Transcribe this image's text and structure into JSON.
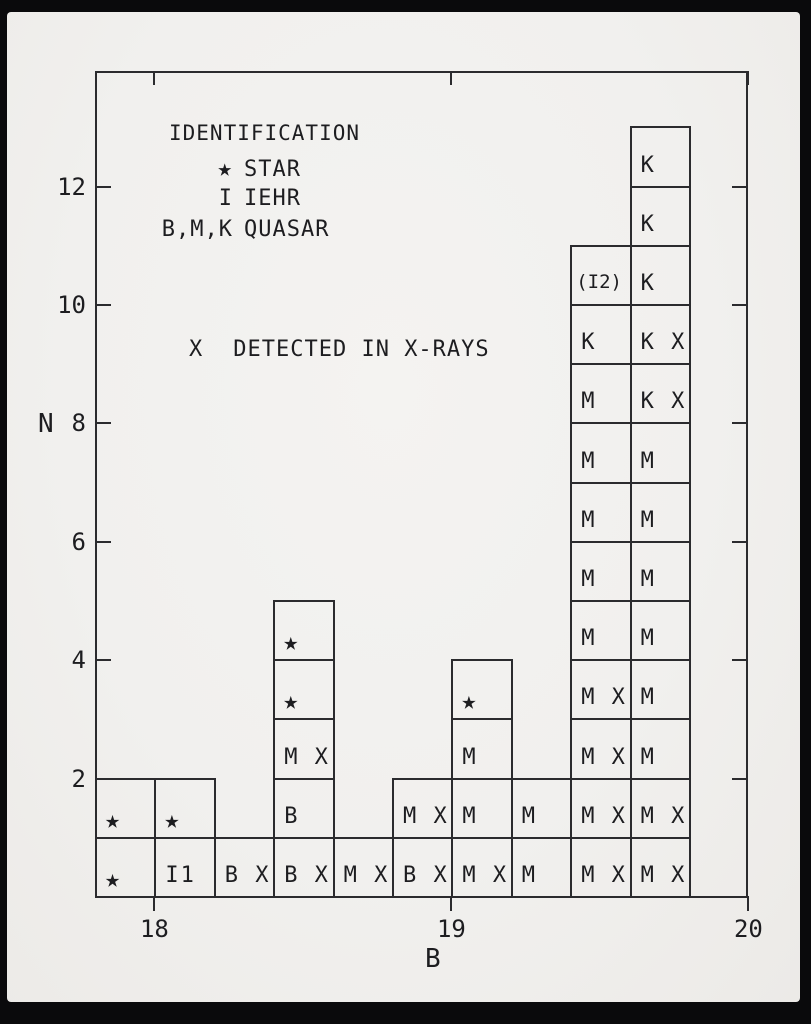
{
  "figure": {
    "paper_color": "#f1f0ee",
    "frame_color": "#0a0a0c",
    "line_color": "#2b2b2e",
    "text_color": "#1d1d20"
  },
  "legend": {
    "title": "IDENTIFICATION",
    "entries": [
      {
        "symbol": "★",
        "label": "STAR"
      },
      {
        "symbol": "I",
        "label": "IEHR"
      },
      {
        "symbol": "B,M,K",
        "label": "QUASAR"
      }
    ],
    "xray": {
      "symbol": "X",
      "label": "DETECTED IN X-RAYS"
    }
  },
  "chart_data": {
    "type": "bar",
    "title": "",
    "xlabel": "B",
    "ylabel": "N",
    "x_ticks": [
      18,
      19,
      20
    ],
    "y_ticks": [
      2,
      4,
      6,
      8,
      10,
      12
    ],
    "xlim": [
      17.8,
      20.0
    ],
    "ylim": [
      0,
      14
    ],
    "bin_width": 0.2,
    "grid": false,
    "legend_position": "upper-left",
    "columns": [
      {
        "b_min": 17.8,
        "b_max": 18.0,
        "count": 2,
        "cells": [
          "★",
          "★"
        ]
      },
      {
        "b_min": 18.0,
        "b_max": 18.2,
        "count": 2,
        "cells": [
          "I1",
          "★"
        ]
      },
      {
        "b_min": 18.2,
        "b_max": 18.4,
        "count": 1,
        "cells": [
          "B X"
        ]
      },
      {
        "b_min": 18.4,
        "b_max": 18.6,
        "count": 5,
        "cells": [
          "B X",
          "B",
          "M X",
          "★",
          "★"
        ]
      },
      {
        "b_min": 18.6,
        "b_max": 18.8,
        "count": 1,
        "cells": [
          "M X"
        ]
      },
      {
        "b_min": 18.8,
        "b_max": 19.0,
        "count": 2,
        "cells": [
          "B X",
          "M X"
        ]
      },
      {
        "b_min": 19.0,
        "b_max": 19.2,
        "count": 4,
        "cells": [
          "M X",
          "M",
          "M",
          "★"
        ]
      },
      {
        "b_min": 19.2,
        "b_max": 19.4,
        "count": 2,
        "cells": [
          "M",
          "M"
        ]
      },
      {
        "b_min": 19.4,
        "b_max": 19.6,
        "count": 11,
        "cells": [
          "M X",
          "M X",
          "M X",
          "M X",
          "M",
          "M",
          "M",
          "M",
          "M",
          "K",
          "(I2)"
        ]
      },
      {
        "b_min": 19.6,
        "b_max": 19.8,
        "count": 13,
        "cells": [
          "M X",
          "M X",
          "M",
          "M",
          "M",
          "M",
          "M",
          "M",
          "K X",
          "K X",
          "K",
          "K",
          "K"
        ]
      }
    ]
  }
}
